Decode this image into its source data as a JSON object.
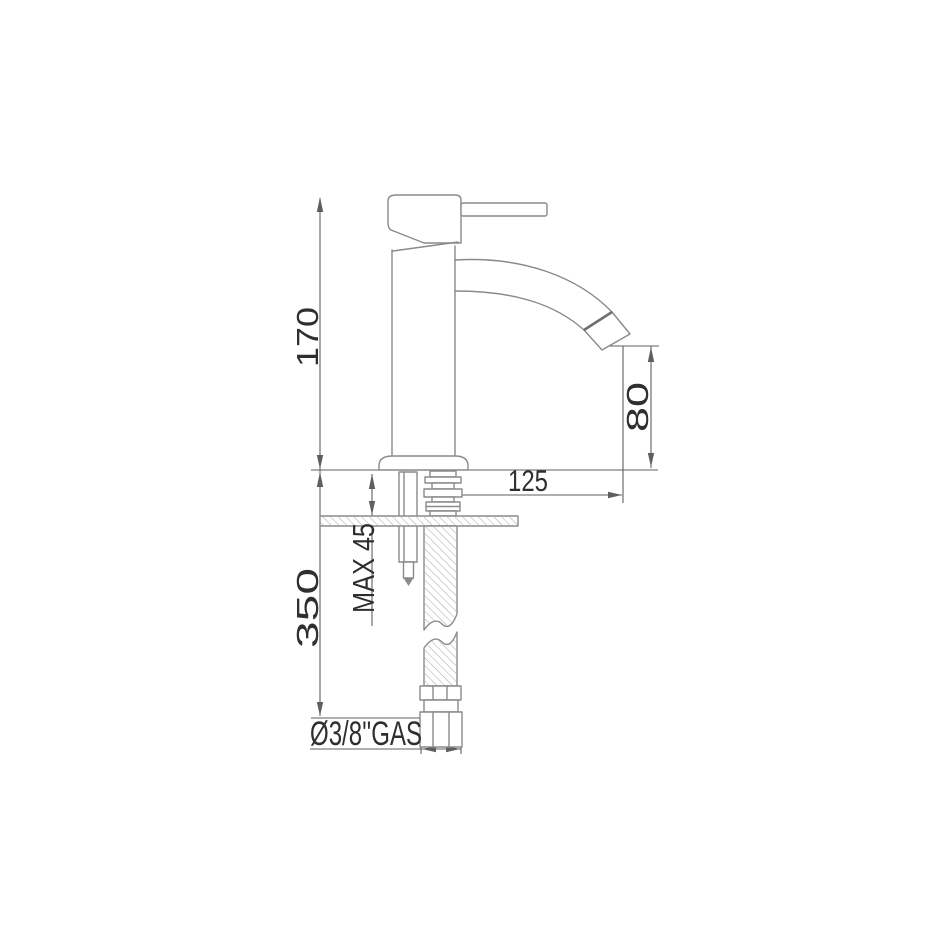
{
  "drawing": {
    "type": "technical-dimension-drawing",
    "subject_view": "side elevation",
    "colors": {
      "background": "#ffffff",
      "part_line": "#8a8a8a",
      "dimension_line": "#5f5f5f",
      "text": "#2f2f2f"
    },
    "dimensions": {
      "tap_height": {
        "label": "170",
        "orientation": "vertical"
      },
      "below_deck_length": {
        "label": "350",
        "orientation": "vertical"
      },
      "max_deck_thickness": {
        "label": "MAX 45",
        "orientation": "vertical"
      },
      "spout_outlet_height": {
        "label": "80",
        "orientation": "vertical"
      },
      "spout_reach": {
        "label": "125",
        "orientation": "horizontal"
      },
      "supply_connection": {
        "label": "Ø3/8''GAS",
        "orientation": "horizontal"
      }
    }
  }
}
